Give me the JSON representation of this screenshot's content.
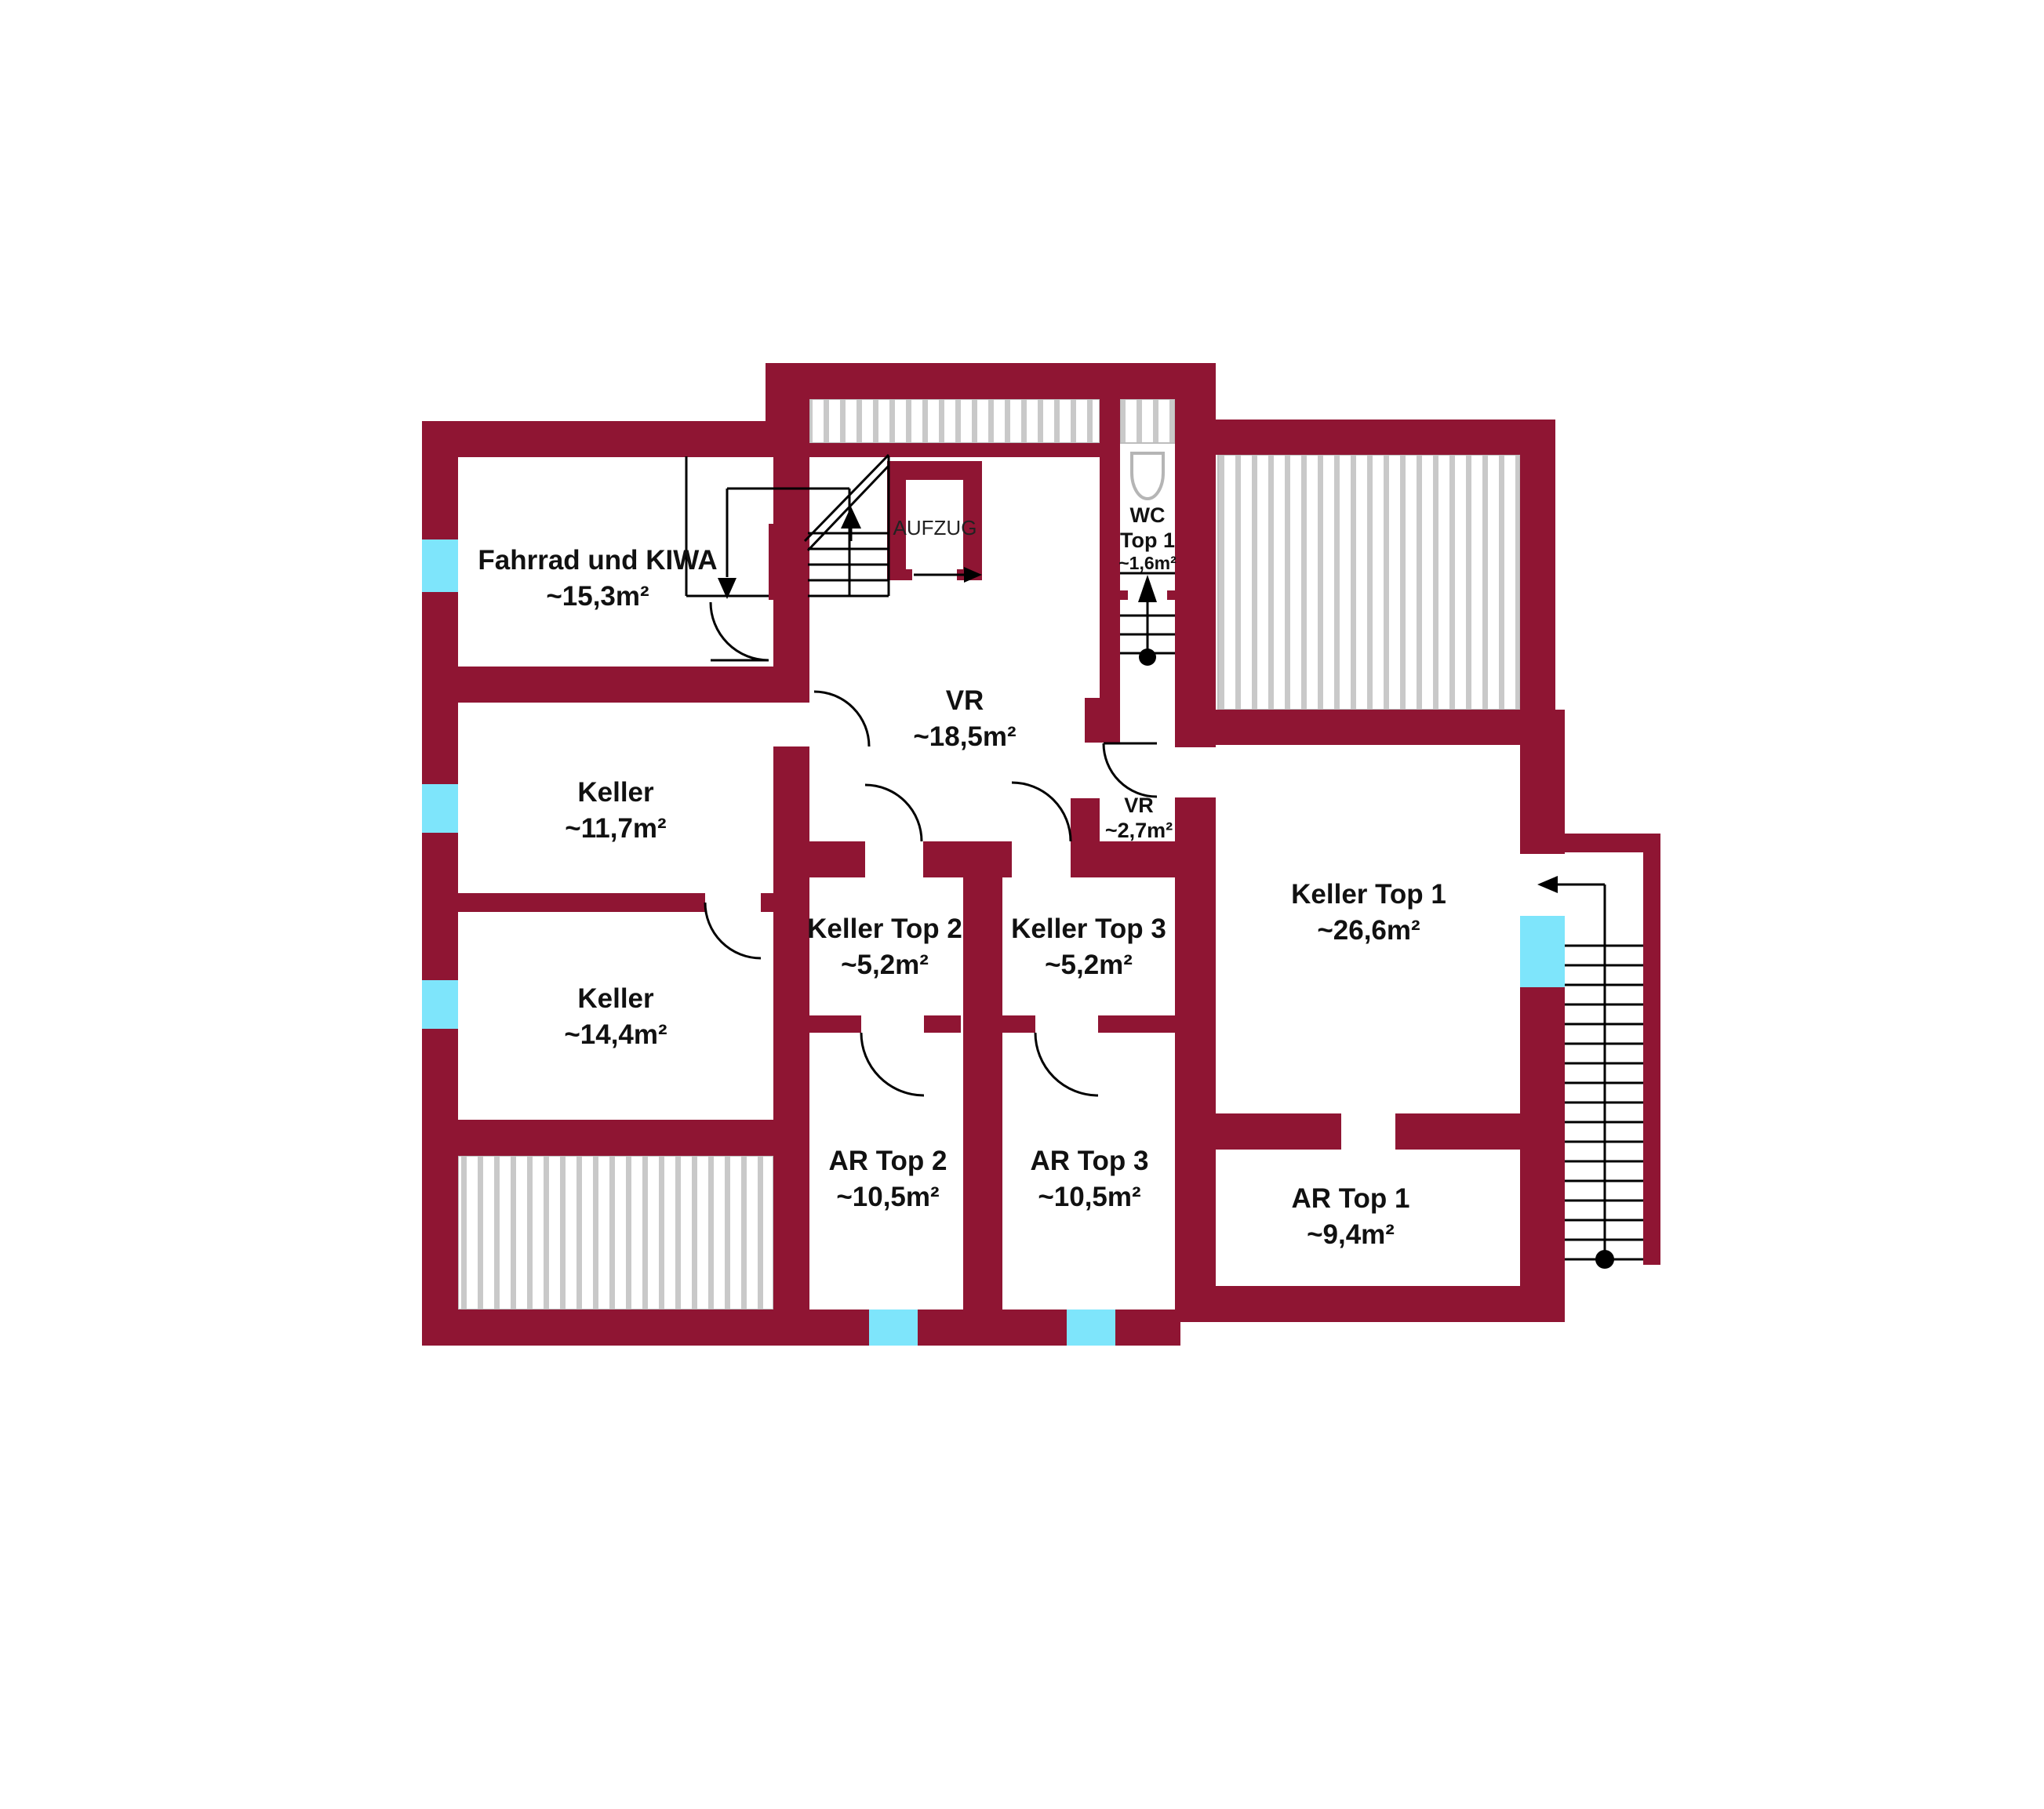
{
  "colors": {
    "wall": "#8f1533",
    "window": "#7ee5fb",
    "hatch_stripe": "#c9c9c9",
    "line": "#000000"
  },
  "rooms": {
    "fahrrad": {
      "name": "Fahrrad und KIWA",
      "area": "~15,3m²"
    },
    "keller_a": {
      "name": "Keller",
      "area": "~11,7m²"
    },
    "keller_b": {
      "name": "Keller",
      "area": "~14,4m²"
    },
    "vr": {
      "name": "VR",
      "area": "~18,5m²"
    },
    "vr_klein": {
      "name": "VR",
      "area": "~2,7m²"
    },
    "wc_top1": {
      "name": "WC",
      "line2": "Top 1",
      "area": "~1,6m²"
    },
    "keller_top2": {
      "name": "Keller Top 2",
      "area": "~5,2m²"
    },
    "keller_top3": {
      "name": "Keller Top 3",
      "area": "~5,2m²"
    },
    "keller_top1": {
      "name": "Keller Top 1",
      "area": "~26,6m²"
    },
    "ar_top2": {
      "name": "AR Top 2",
      "area": "~10,5m²"
    },
    "ar_top3": {
      "name": "AR Top 3",
      "area": "~10,5m²"
    },
    "ar_top1": {
      "name": "AR Top 1",
      "area": "~9,4m²"
    }
  },
  "labels": {
    "elevator": "AUFZUG"
  }
}
